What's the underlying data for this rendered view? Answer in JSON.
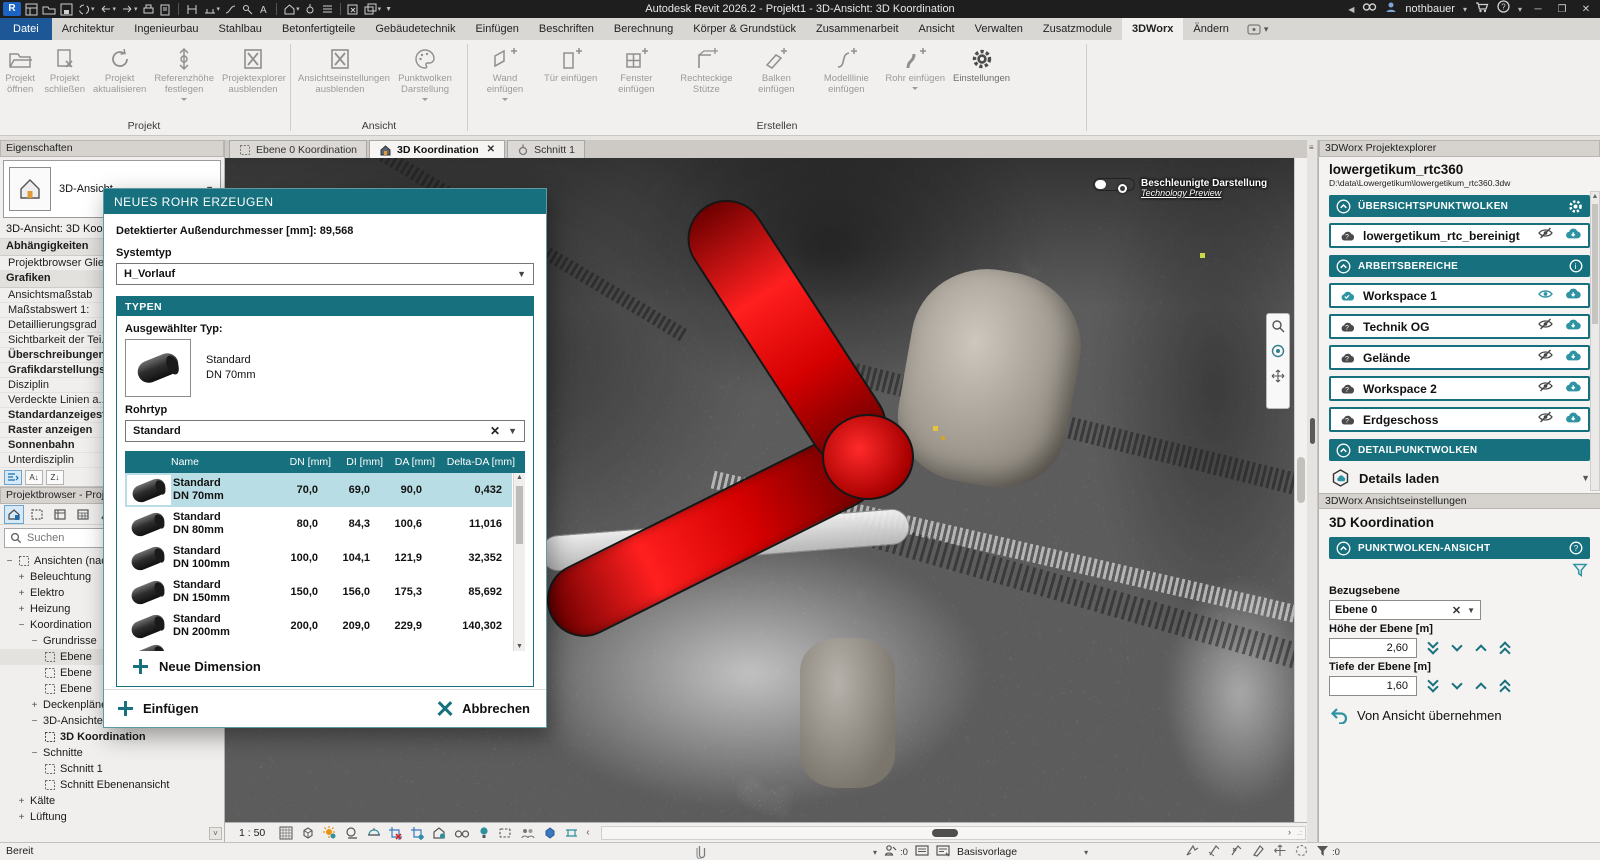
{
  "title_bar": {
    "title": "Autodesk Revit 2026.2 - Projekt1 - 3D-Ansicht: 3D Koordination",
    "user": "nothbauer"
  },
  "ribbon": {
    "tabs": [
      "Datei",
      "Architektur",
      "Ingenieurbau",
      "Stahlbau",
      "Betonfertigteile",
      "Gebäudetechnik",
      "Einfügen",
      "Beschriften",
      "Berechnung",
      "Körper & Grundstück",
      "Zusammenarbeit",
      "Ansicht",
      "Verwalten",
      "Zusatzmodule",
      "3DWorx",
      "Ändern"
    ],
    "groups": [
      {
        "label": "Projekt",
        "buttons": [
          {
            "label": "Projekt öffnen"
          },
          {
            "label": "Projekt schließen"
          },
          {
            "label": "Projekt aktualisieren"
          },
          {
            "label": "Referenzhöhe festlegen"
          },
          {
            "label": "Projektexplorer ausblenden"
          }
        ]
      },
      {
        "label": "Ansicht",
        "buttons": [
          {
            "label": "Ansichtseinstellungen ausblenden"
          },
          {
            "label": "Punktwolken Darstellung"
          }
        ]
      },
      {
        "label": "Erstellen",
        "buttons": [
          {
            "label": "Wand einfügen"
          },
          {
            "label": "Tür einfügen"
          },
          {
            "label": "Fenster einfügen"
          },
          {
            "label": "Rechteckige Stütze"
          },
          {
            "label": "Balken einfügen"
          },
          {
            "label": "Modelllinie einfügen"
          },
          {
            "label": "Rohr einfügen"
          },
          {
            "label": "Einstellungen"
          }
        ]
      }
    ]
  },
  "view_tabs": [
    {
      "label": "Ebene 0 Koordination"
    },
    {
      "label": "3D Koordination"
    },
    {
      "label": "Schnitt 1"
    }
  ],
  "properties": {
    "header": "Eigenschaften",
    "type_name": "3D-Ansicht",
    "view_name": "3D-Ansicht: 3D Koord",
    "rows": [
      {
        "label": "Abhängigkeiten"
      },
      {
        "label": "Projektbrowser Glie..."
      },
      {
        "label": "Grafiken"
      },
      {
        "label": "Ansichtsmaßstab"
      },
      {
        "label": "Maßstabswert 1:"
      },
      {
        "label": "Detaillierungsgrad"
      },
      {
        "label": "Sichtbarkeit der Tei..."
      },
      {
        "label": "Überschreibungen ..."
      },
      {
        "label": "Grafikdarstellungso..."
      },
      {
        "label": "Disziplin"
      },
      {
        "label": "Verdeckte Linien a..."
      },
      {
        "label": "Standardanzeigestil..."
      },
      {
        "label": "Raster anzeigen"
      },
      {
        "label": "Sonnenbahn"
      },
      {
        "label": "Unterdisziplin"
      }
    ]
  },
  "project_browser": {
    "header": "Projektbrowser - Proje",
    "search_placeholder": "Suchen",
    "tree": [
      {
        "label": "Ansichten (nac"
      },
      {
        "label": "Beleuchtung"
      },
      {
        "label": "Elektro"
      },
      {
        "label": "Heizung"
      },
      {
        "label": "Koordination"
      },
      {
        "label": "Grundrisse"
      },
      {
        "label": "Ebene"
      },
      {
        "label": "Ebene"
      },
      {
        "label": "Ebene"
      },
      {
        "label": "Deckenpläne"
      },
      {
        "label": "3D-Ansichten"
      },
      {
        "label": "3D Koordination"
      },
      {
        "label": "Schnitte"
      },
      {
        "label": "Schnitt 1"
      },
      {
        "label": "Schnitt Ebenenansicht"
      },
      {
        "label": "Kälte"
      },
      {
        "label": "Lüftung"
      }
    ]
  },
  "canvas": {
    "scale": "1 : 50",
    "accel_label": "Beschleunigte Darstellung",
    "accel_sub": "Technology Preview"
  },
  "dialog": {
    "title": "NEUES ROHR ERZEUGEN",
    "detected": "Detektierter Außendurchmesser [mm]: 89,568",
    "systemtyp_label": "Systemtyp",
    "systemtyp_value": "H_Vorlauf",
    "typen_label": "TYPEN",
    "selected_type_label": "Ausgewählter Typ:",
    "selected_type_name": "Standard",
    "selected_type_size": "DN 70mm",
    "rohrtyp_label": "Rohrtyp",
    "rohrtyp_value": "Standard",
    "table": {
      "headers": [
        "Name",
        "DN [mm]",
        "DI [mm]",
        "DA [mm]",
        "Delta-DA [mm]"
      ],
      "rows": [
        {
          "name1": "Standard",
          "name2": "DN 70mm",
          "dn": "70,0",
          "di": "69,0",
          "da": "90,0",
          "delta": "0,432"
        },
        {
          "name1": "Standard",
          "name2": "DN 80mm",
          "dn": "80,0",
          "di": "84,3",
          "da": "100,6",
          "delta": "11,016"
        },
        {
          "name1": "Standard",
          "name2": "DN 100mm",
          "dn": "100,0",
          "di": "104,1",
          "da": "121,9",
          "delta": "32,352"
        },
        {
          "name1": "Standard",
          "name2": "DN 150mm",
          "dn": "150,0",
          "di": "156,0",
          "da": "175,3",
          "delta": "85,692"
        },
        {
          "name1": "Standard",
          "name2": "DN 200mm",
          "dn": "200,0",
          "di": "209,0",
          "da": "229,9",
          "delta": "140,302"
        }
      ]
    },
    "new_dimension_label": "Neue Dimension",
    "insert_label": "Einfügen",
    "cancel_label": "Abbrechen"
  },
  "explorer": {
    "header": "3DWorx Projektexplorer",
    "project_name": "lowergetikum_rtc360",
    "project_path": "D:\\data\\Lowergetikum\\lowergetikum_rtc360.3dw",
    "overview_section": "ÜBERSICHTSPUNKTWOLKEN",
    "overview_item": "lowergetikum_rtc_bereinigt",
    "workspaces_section": "ARBEITSBEREICHE",
    "workspaces": [
      {
        "label": "Workspace 1"
      },
      {
        "label": "Technik OG"
      },
      {
        "label": "Gelände"
      },
      {
        "label": "Workspace 2"
      },
      {
        "label": "Erdgeschoss"
      }
    ],
    "detail_section": "DETAILPUNKTWOLKEN",
    "detail_action": "Details laden"
  },
  "view_settings": {
    "header": "3DWorx Ansichtseinstellungen",
    "view_name": "3D Koordination",
    "section": "PUNKTWOLKEN-ANSICHT",
    "ref_plane_label": "Bezugsebene",
    "ref_plane_value": "Ebene 0",
    "height_label": "Höhe der Ebene [m]",
    "height_value": "2,60",
    "depth_label": "Tiefe der Ebene [m]",
    "depth_value": "1,60",
    "apply_label": "Von Ansicht übernehmen"
  },
  "status_bar": {
    "ready": "Bereit",
    "template": "Basisvorlage",
    "editable_count": ":0",
    "filter_count": ":0"
  },
  "colors": {
    "teal": "#16707e",
    "selection": "#b9dde4",
    "datei_blue": "#1d5796",
    "pipe_red": "#e00000"
  }
}
